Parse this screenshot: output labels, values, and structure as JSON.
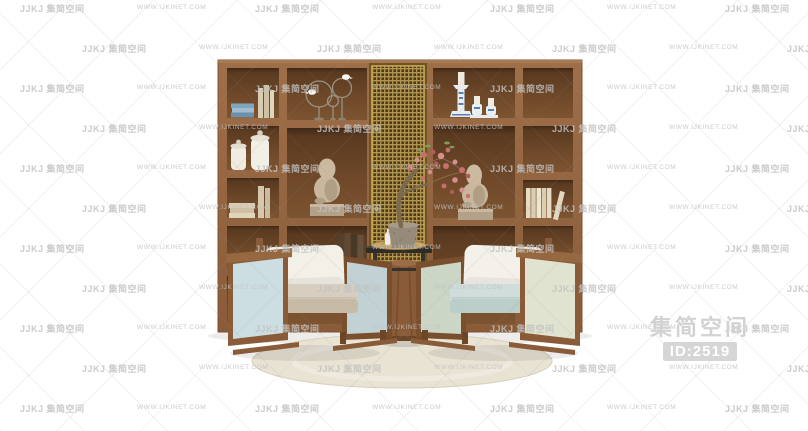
{
  "watermark": {
    "logo": "JJKJ 集简空间",
    "url": "WWW.IJKINET.COM"
  },
  "badge": {
    "brand": "集简空间",
    "id": "ID:2519"
  },
  "colors": {
    "wood": "#8a5b38",
    "wood-face": "#976743",
    "wood-dark": "#6d4527",
    "mesh-gold": "#b2954e",
    "mesh-dark": "#4d3b1c",
    "rug": "#e9e3d4",
    "panel-blue": "#cddee2",
    "panel-green": "#e0e3cf",
    "cushion-tan": "#d8cec0",
    "cushion-blue": "#cfdeda",
    "pillow": "#f3f0e8",
    "statue": "#c8b79d",
    "blossom": "#c76e6e",
    "porcelain-blue": "#5b7fae",
    "watermark-gray": "#c2c2c2",
    "badge-gray": "#d6d6d6"
  }
}
